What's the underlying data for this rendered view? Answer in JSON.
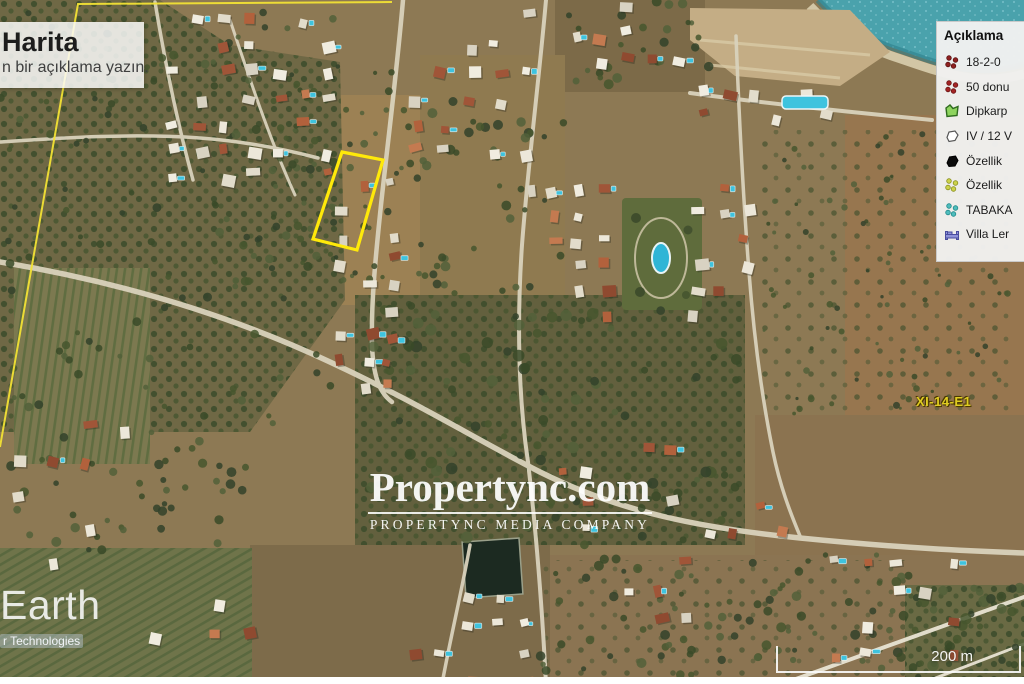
{
  "title_box": {
    "title": "Harita",
    "subtitle": "n bir açıklama yazın."
  },
  "legend": {
    "title": "Açıklama",
    "items": [
      {
        "label": "18-2-0",
        "icon": "cluster-dots-icon",
        "color": "#8e2020",
        "stroke": "#5c1212"
      },
      {
        "label": "50 donu",
        "icon": "cluster-dots-icon",
        "color": "#a32424",
        "stroke": "#6b1616"
      },
      {
        "label": "Dipkarp",
        "icon": "green-polygon-icon",
        "color": "#8ed45e",
        "stroke": "#2f6b1f"
      },
      {
        "label": "IV / 12 V",
        "icon": "white-polygon-icon",
        "color": "#ffffff",
        "stroke": "#555555"
      },
      {
        "label": "Özellik",
        "icon": "black-polygon-icon",
        "color": "#0b0b0b",
        "stroke": "#000000"
      },
      {
        "label": "Özellik",
        "icon": "cluster-dots-icon",
        "color": "#ccd24a",
        "stroke": "#8a8f1f"
      },
      {
        "label": "TABAKA",
        "icon": "cluster-dots-icon",
        "color": "#4fbcbc",
        "stroke": "#1f8a8a"
      },
      {
        "label": "Villa Ler",
        "icon": "bed-icon",
        "color": "#8f92d8",
        "stroke": "#4a4d9e"
      }
    ]
  },
  "watermark": {
    "brand": "Propertync.com",
    "tagline": "PROPERTYNC MEDIA COMPANY"
  },
  "earth_watermark": "Earth",
  "attribution": "r Technologies",
  "scale_bar": {
    "label": "200 m"
  },
  "map": {
    "plot_label": "XI-14-E1",
    "plot_outline_color": "#ffe90a",
    "boundary_line_color": "#f2e235",
    "sea_color": "#4aa2ac"
  }
}
